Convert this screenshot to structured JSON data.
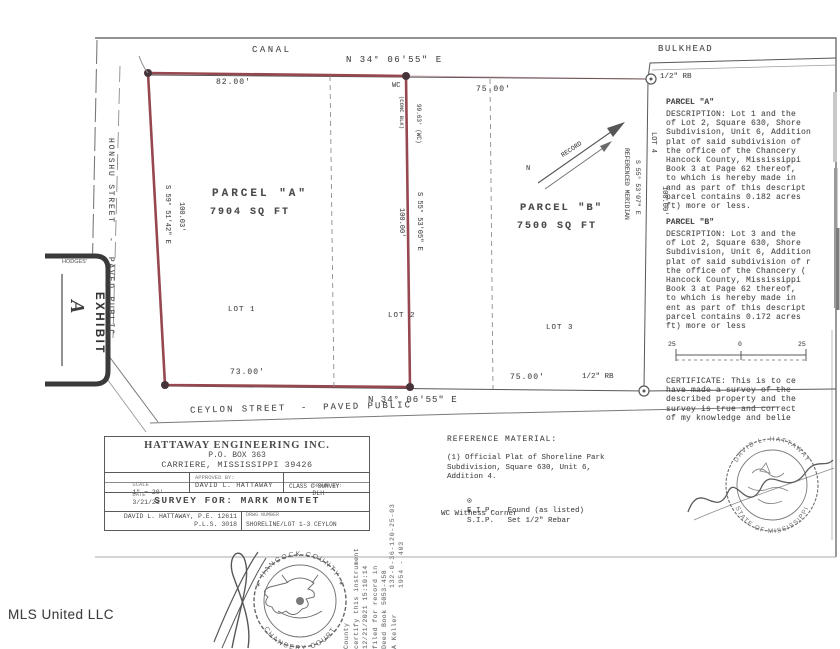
{
  "watermark": "MLS United LLC",
  "plat": {
    "canal": "CANAL",
    "bulkhead": "BULKHEAD",
    "bearing_top": "N 34° 06'55\" E",
    "bearing_bottom": "N 34° 06'55\" E",
    "street_left": "HONSHU STREET  -  PAVED PUBLIC",
    "street_bottom": "CEYLON STREET  -  PAVED PUBLIC",
    "dim_top_left": "82.00'",
    "dim_top_right": "75.00'",
    "dim_bottom_left": "73.00'",
    "dim_bottom_right": "75.00'",
    "rb_top": "1/2\" RB",
    "rb_bottom": "1/2\" RB",
    "wc": "WC",
    "conc": "(CONC BLK)",
    "wc_dim": "99.63' (WC)",
    "bearing_left": "S 59° 51'42\" E",
    "dist_left": "100.03'",
    "bearing_mid": "S 55° 53'05\" E",
    "dist_mid": "100.00'",
    "ref_meridian": "REFERENCED MERIDIAN",
    "bearing_right": "S 55° 53'07\" E",
    "dist_right": "100.00'",
    "lot1": "LOT 1",
    "lot2": "LOT 2",
    "lot3": "LOT 3",
    "lot4": "LOT 4",
    "parcel_a_name": "PARCEL \"A\"",
    "parcel_a_area": "7904 SQ FT",
    "parcel_b_name": "PARCEL \"B\"",
    "parcel_b_area": "7500 SQ FT",
    "record": "RECORD",
    "north": "N",
    "scale_left": "25",
    "scale_zero": "0",
    "scale_right": "25"
  },
  "exhibit": {
    "brand": "HODGES'",
    "label": "EXHIBIT",
    "letter": "A"
  },
  "descriptions": {
    "a_title": "PARCEL \"A\"",
    "a_body": "DESCRIPTION: Lot 1 and the\nof Lot 2, Square 630, Shore\nSubdivision, Unit 6, Addition\nplat of said subdivision of\nthe office of the Chancery\nHancock County, Mississippi\nBook 3 at Page 62 thereof,\nto which is hereby made in\nand as part of this descript\nparcel contains 0.182 acres\nft) more or less.",
    "b_title": "PARCEL \"B\"",
    "b_body": "DESCRIPTION: Lot 3 and the\nof Lot 2, Square 630, Shore\nSubdivision, Unit 6, Addition\nplat of said subdivision of r\nthe office of the Chancery (\nHancock County, Mississippi\nBook 3 at Page 62 thereof,\nto which is hereby made in\nent as part of this descript\nparcel contains 0.172 acres\nft) more or less",
    "certificate": "CERTIFICATE:  This is to ce\nhave made a survey of the\ndescribed property and the\nsurvey is true and correct\nof my knowledge and belie"
  },
  "reference": {
    "heading": "REFERENCE MATERIAL:",
    "item1": "(1) Official Plat of Shoreline Park\n      Subdivision, Square 630, Unit 6,\n      Addition 4.",
    "fip_symbol": "⊙",
    "fip_text": "F.I.P.   Found (as listed)",
    "sip_symbol": "●",
    "sip_text": "S.I.P.   Set 1/2\" Rebar",
    "wc_text": "WC Witness Corner"
  },
  "titleblock": {
    "company": "HATTAWAY ENGINEERING INC.",
    "address1": "P.O. BOX 363",
    "address2": "CARRIERE, MISSISSIPPI 39426",
    "scale_label": "SCALE",
    "scale_value": "1\" = 20'",
    "date_label": "DATE",
    "date_value": "3/21/21",
    "approved_label": "APPROVED BY:",
    "approved_value": "DAVID L. HATTAWAY",
    "drawn_label": "DRAWN BY:",
    "drawn_value": "DLH",
    "class_value": "CLASS C SURVEY",
    "survey_for": "SURVEY FOR: MARK MONTET",
    "pe": "DAVID L. HATTAWAY, P.E. 12611",
    "pls": "P.L.S. 3018",
    "drwg_label": "DRWG NUMBER",
    "drwg_value": "SHORELINE/LOT 1-3 CEYLON"
  },
  "seals": {
    "surveyor_top": "DAVID L. HATTAWAY",
    "surveyor_bottom": "STATE OF MISSISSIPPI",
    "county_top": "✶ HANCOCK COUNTY ✶",
    "county_bottom": "CHANCERY COURT"
  },
  "stamps": {
    "recording": "County\ncertify this instrument\n12/21/2021 15:10:14\nfiled for record in\nDeed Book 5053-458\nA Keller",
    "parcel_id": "132-0-36-120-25-03\n1954 - 403"
  }
}
